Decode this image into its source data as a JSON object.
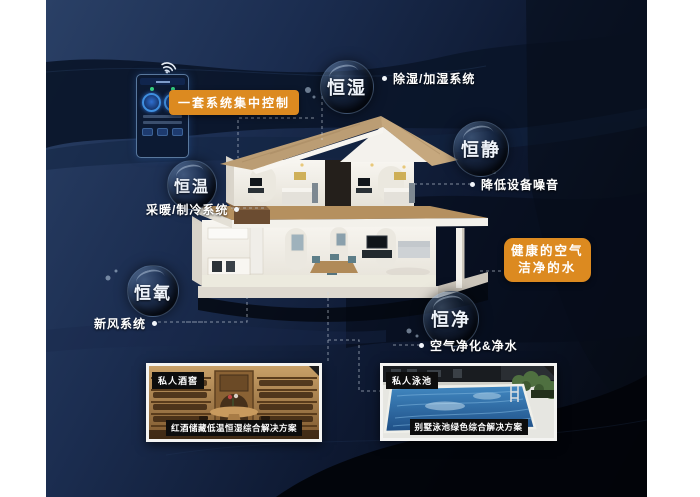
{
  "palette": {
    "accent_orange": "#DC8A20",
    "background_navy": "#1B2D50",
    "background_dark": "#04070E",
    "bubble_rim": "#96B6DA",
    "pool_blue": "#2E6FA8",
    "wood_tan": "#B5905F"
  },
  "control_badge": {
    "label": "一套系统集中控制"
  },
  "health_badge": {
    "line1": "健康的空气",
    "line2": "洁净的水"
  },
  "features": [
    {
      "bubble": "恒湿",
      "label": "除湿/加湿系统"
    },
    {
      "bubble": "恒静",
      "label": "降低设备噪音"
    },
    {
      "bubble": "恒温",
      "label": "采暖/制冷系统"
    },
    {
      "bubble": "恒氧",
      "label": "新风系统"
    },
    {
      "bubble": "恒净",
      "label": "空气净化&净水"
    }
  ],
  "cards": [
    {
      "tag": "私人酒窖",
      "caption": "红酒储藏低温恒湿综合解决方案"
    },
    {
      "tag": "私人泳池",
      "caption": "别墅泳池绿色综合解决方案"
    }
  ]
}
